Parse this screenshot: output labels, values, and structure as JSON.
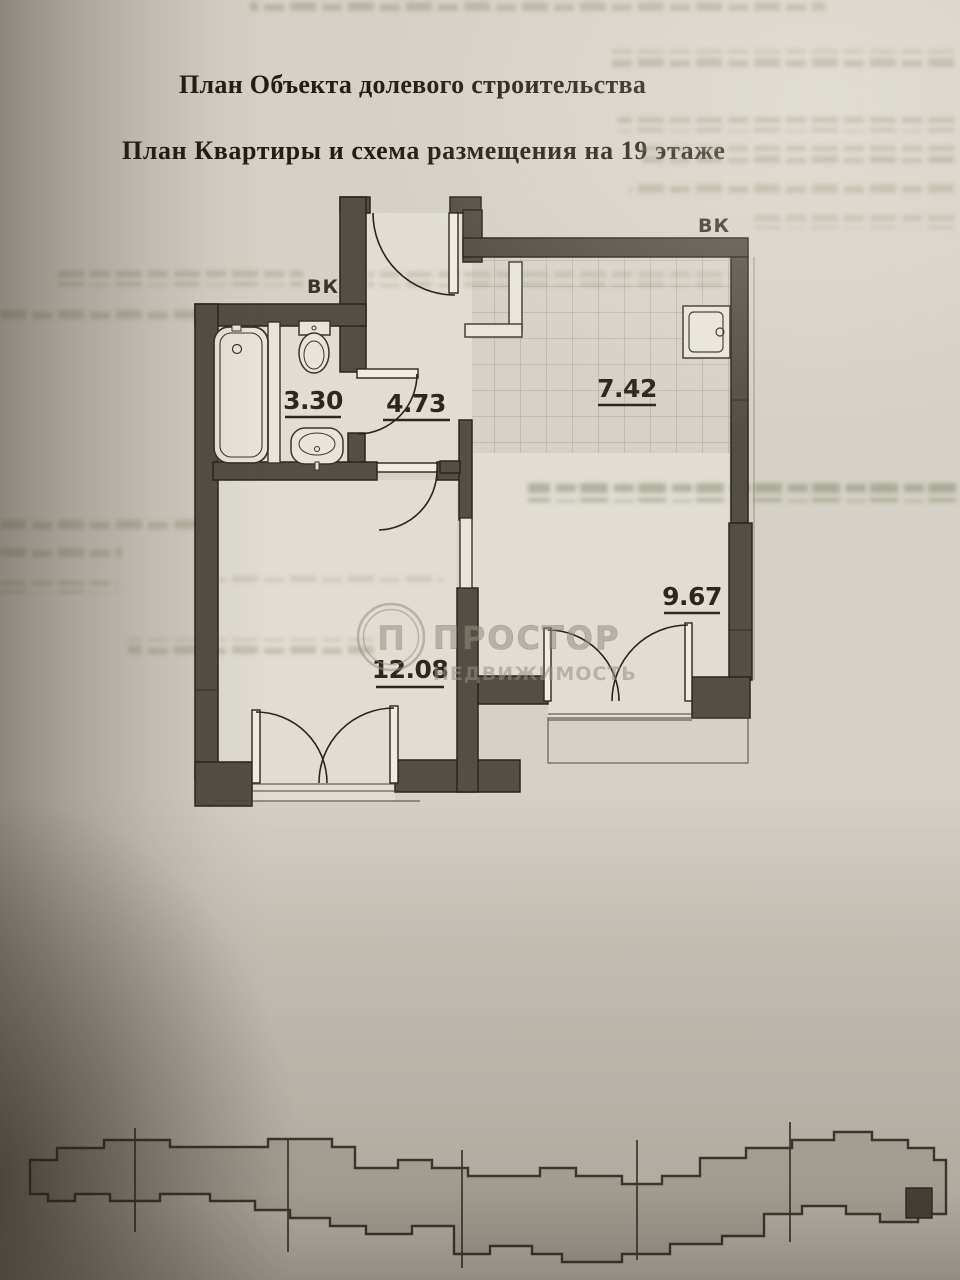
{
  "document": {
    "title_line1": "План Объекта долевого строительства",
    "title_line2": "План Квартиры и схема размещения на 19 этаже"
  },
  "floor_plan": {
    "vent_label_left": "ВК",
    "vent_label_right": "ВК",
    "rooms": {
      "hallway": {
        "area": "4.73"
      },
      "bathroom": {
        "area": "3.30"
      },
      "kitchen": {
        "area": "7.42"
      },
      "living_room": {
        "area": "12.08"
      },
      "bedroom": {
        "area": "9.67"
      }
    }
  },
  "watermark": {
    "logo_letter": "П",
    "name": "ПРОСТОР",
    "subtitle": "НЕДВИЖИМОСТЬ"
  },
  "colors": {
    "paper": "#d6d1c6",
    "wall": "#554e44",
    "ink": "#2a251f",
    "watermark_gray": "#968f82",
    "bleed_text": "#8b8568"
  }
}
